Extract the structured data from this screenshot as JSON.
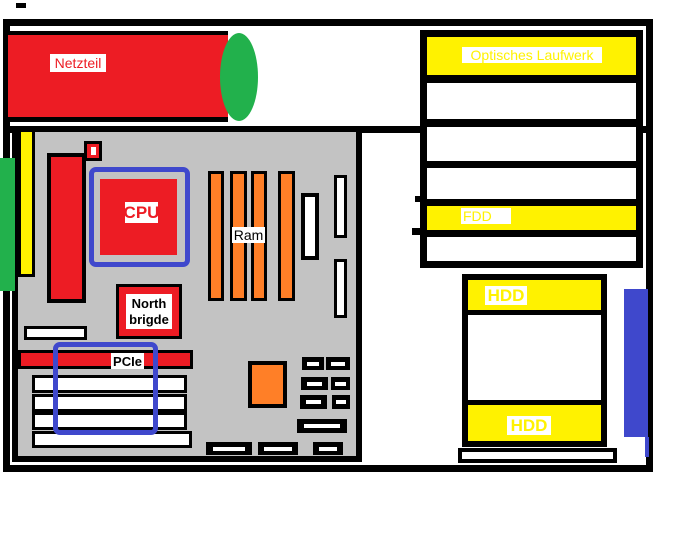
{
  "diagram_title": "PC case component layout sketch",
  "colors": {
    "red": "#ED1C24",
    "green": "#22B14C",
    "yellow": "#FFF200",
    "orange": "#FF7F27",
    "blue": "#3F48CC",
    "gray": "#C3C3C3",
    "black": "#000000",
    "white": "#FFFFFF"
  },
  "labels": {
    "power_supply": "Netzteil",
    "cpu": "CPU",
    "ram": "Ram",
    "north_bridge_line1": "North",
    "north_bridge_line2": "brigde",
    "pcie": "PCIe",
    "optical_drive": "Optisches Laufwerk",
    "floppy_drive": "FDD",
    "hdd_upper": "HDD",
    "hdd_lower": "HDD"
  }
}
